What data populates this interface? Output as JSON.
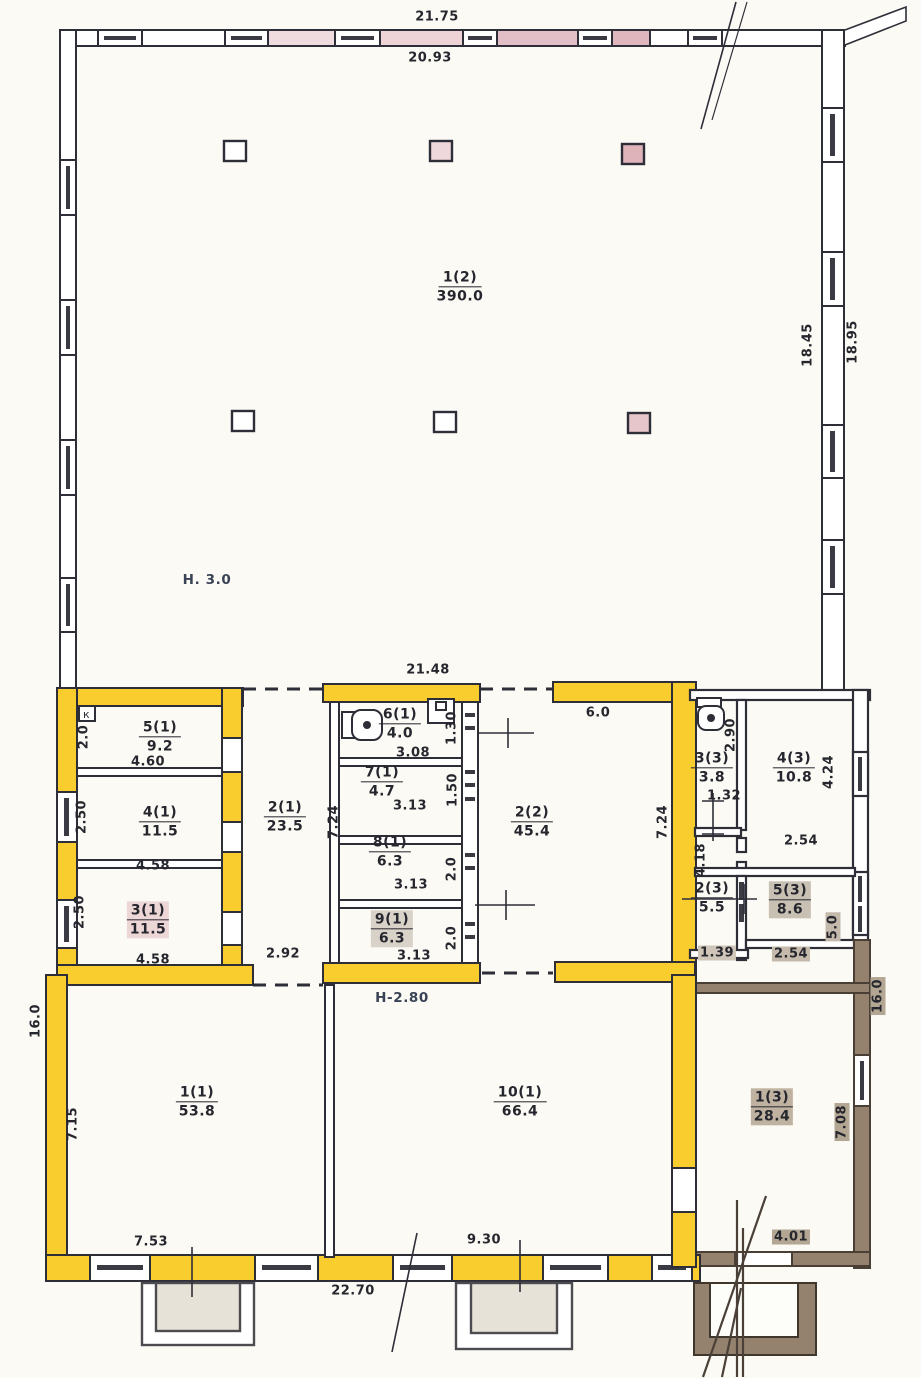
{
  "document": {
    "type": "hand-drawn building floor plan (technical inventory drawing)",
    "storey_note_main": "Н. 3.0",
    "storey_note_lower": "Н-2.80",
    "panel_mark": "к"
  },
  "colors": {
    "highlight_yellow": "#FACD2F",
    "wall_pink": "#E9CBD1",
    "annex_brown": "#94826F",
    "ink": "#2E2E38",
    "paper": "#FBFAF4"
  },
  "rooms": [
    {
      "number": "1(2)",
      "area": "390.0",
      "x": 460,
      "y": 287
    },
    {
      "number": "5(1)",
      "area": "9.2",
      "x": 160,
      "y": 737
    },
    {
      "number": "4(1)",
      "area": "11.5",
      "x": 160,
      "y": 822
    },
    {
      "number": "3(1)",
      "area": "11.5",
      "x": 148,
      "y": 920,
      "hl": "#EDD6D6"
    },
    {
      "number": "2(1)",
      "area": "23.5",
      "x": 285,
      "y": 817
    },
    {
      "number": "6(1)",
      "area": "4.0",
      "x": 400,
      "y": 724
    },
    {
      "number": "7(1)",
      "area": "4.7",
      "x": 382,
      "y": 782
    },
    {
      "number": "8(1)",
      "area": "6.3",
      "x": 390,
      "y": 852
    },
    {
      "number": "9(1)",
      "area": "6.3",
      "x": 392,
      "y": 929,
      "hl": "#D9D2C9"
    },
    {
      "number": "2(2)",
      "area": "45.4",
      "x": 532,
      "y": 822
    },
    {
      "number": "3(3)",
      "area": "3.8",
      "x": 712,
      "y": 768
    },
    {
      "number": "4(3)",
      "area": "10.8",
      "x": 794,
      "y": 768
    },
    {
      "number": "2(3)",
      "area": "5.5",
      "x": 712,
      "y": 898
    },
    {
      "number": "5(3)",
      "area": "8.6",
      "x": 790,
      "y": 900,
      "hl": "#C9C0B4"
    },
    {
      "number": "1(1)",
      "area": "53.8",
      "x": 197,
      "y": 1102
    },
    {
      "number": "10(1)",
      "area": "66.4",
      "x": 520,
      "y": 1102
    },
    {
      "number": "1(3)",
      "area": "28.4",
      "x": 772,
      "y": 1107,
      "hl": "#BFB2A0"
    }
  ],
  "dimensions": [
    {
      "text": "21.75",
      "x": 437,
      "y": 17,
      "rot": 0
    },
    {
      "text": "20.93",
      "x": 430,
      "y": 58,
      "rot": 0
    },
    {
      "text": "18.45",
      "x": 808,
      "y": 345,
      "rot": -90
    },
    {
      "text": "18.95",
      "x": 853,
      "y": 342,
      "rot": -90
    },
    {
      "text": "21.48",
      "x": 428,
      "y": 670,
      "rot": 0
    },
    {
      "text": "6.0",
      "x": 598,
      "y": 713,
      "rot": 0
    },
    {
      "text": "2.0",
      "x": 84,
      "y": 737,
      "rot": -90
    },
    {
      "text": "4.60",
      "x": 148,
      "y": 762,
      "rot": 0
    },
    {
      "text": "2.50",
      "x": 82,
      "y": 817,
      "rot": -90
    },
    {
      "text": "4.58",
      "x": 153,
      "y": 866,
      "rot": 0
    },
    {
      "text": "2.50",
      "x": 80,
      "y": 912,
      "rot": -90
    },
    {
      "text": "4.58",
      "x": 153,
      "y": 960,
      "rot": 0
    },
    {
      "text": "2.92",
      "x": 283,
      "y": 954,
      "rot": 0
    },
    {
      "text": "7.24",
      "x": 334,
      "y": 822,
      "rot": -90
    },
    {
      "text": "3.08",
      "x": 413,
      "y": 753,
      "rot": 0
    },
    {
      "text": "1.30",
      "x": 452,
      "y": 728,
      "rot": -90
    },
    {
      "text": "3.13",
      "x": 410,
      "y": 806,
      "rot": 0
    },
    {
      "text": "1.50",
      "x": 453,
      "y": 790,
      "rot": -90
    },
    {
      "text": "3.13",
      "x": 411,
      "y": 885,
      "rot": 0
    },
    {
      "text": "2.0",
      "x": 452,
      "y": 869,
      "rot": -90
    },
    {
      "text": "3.13",
      "x": 414,
      "y": 956,
      "rot": 0
    },
    {
      "text": "2.0",
      "x": 452,
      "y": 938,
      "rot": -90
    },
    {
      "text": "7.24",
      "x": 663,
      "y": 822,
      "rot": -90
    },
    {
      "text": "2.90",
      "x": 731,
      "y": 735,
      "rot": -90
    },
    {
      "text": "4.24",
      "x": 829,
      "y": 772,
      "rot": -90
    },
    {
      "text": "1.32",
      "x": 724,
      "y": 796,
      "rot": 0
    },
    {
      "text": "2.54",
      "x": 801,
      "y": 841,
      "rot": 0
    },
    {
      "text": "4.18",
      "x": 701,
      "y": 860,
      "rot": -90
    },
    {
      "text": "5.0",
      "x": 833,
      "y": 927,
      "rot": -90,
      "hl": "#C4B9AB"
    },
    {
      "text": "1.39",
      "x": 717,
      "y": 953,
      "rot": 0,
      "hl": "#CFC5B8"
    },
    {
      "text": "2.54",
      "x": 791,
      "y": 954,
      "rot": 0,
      "hl": "#C4B9AB"
    },
    {
      "text": "16.0",
      "x": 36,
      "y": 1021,
      "rot": -90
    },
    {
      "text": "7.15",
      "x": 73,
      "y": 1124,
      "rot": -90
    },
    {
      "text": "7.53",
      "x": 151,
      "y": 1242,
      "rot": 0
    },
    {
      "text": "9.30",
      "x": 484,
      "y": 1240,
      "rot": 0
    },
    {
      "text": "22.70",
      "x": 353,
      "y": 1291,
      "rot": 0
    },
    {
      "text": "16.0",
      "x": 878,
      "y": 996,
      "rot": -90,
      "hl": "#B3A693"
    },
    {
      "text": "7.08",
      "x": 842,
      "y": 1122,
      "rot": -90,
      "hl": "#B3A693"
    },
    {
      "text": "4.01",
      "x": 791,
      "y": 1237,
      "rot": 0,
      "hl": "#B3A693"
    }
  ],
  "annotations": [
    {
      "text": "Н. 3.0",
      "x": 207,
      "y": 580
    },
    {
      "text": "Н-2.80",
      "x": 402,
      "y": 998
    }
  ]
}
